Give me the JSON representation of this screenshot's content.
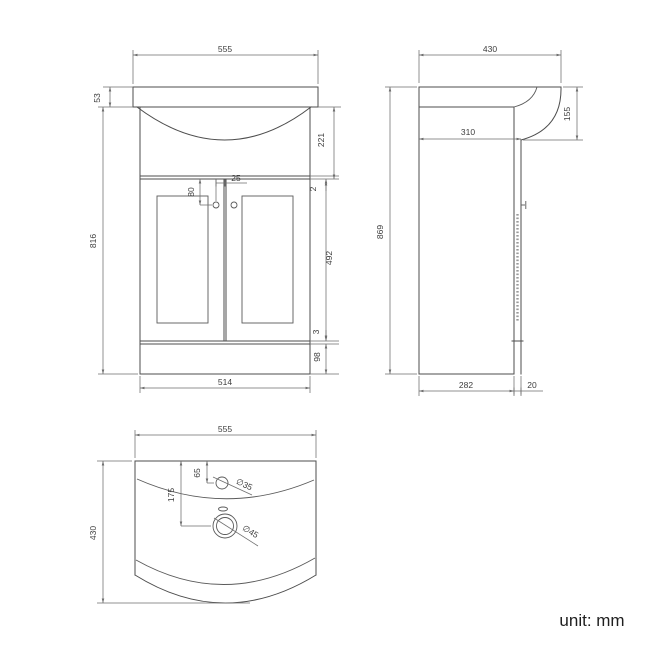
{
  "front_view": {
    "overall_width": "555",
    "rim_height": "53",
    "basin_height": "221",
    "top_gap": "2",
    "handle_drop": "80",
    "handle_spacing": "25",
    "door_height": "492",
    "bottom_gap": "3",
    "plinth_height": "98",
    "body_height": "816",
    "cabinet_width": "514"
  },
  "side_view": {
    "overall_depth": "430",
    "basin_front_height": "155",
    "top_depth": "310",
    "overall_height": "869",
    "cabinet_depth": "282",
    "door_thickness": "20"
  },
  "plan_view": {
    "overall_width": "555",
    "overall_depth": "430",
    "tap_hole_offset": "65",
    "waste_hole_offset": "175",
    "tap_hole_diameter": "∅35",
    "waste_hole_diameter": "∅45"
  },
  "footer": {
    "unit_label": "unit: mm"
  }
}
